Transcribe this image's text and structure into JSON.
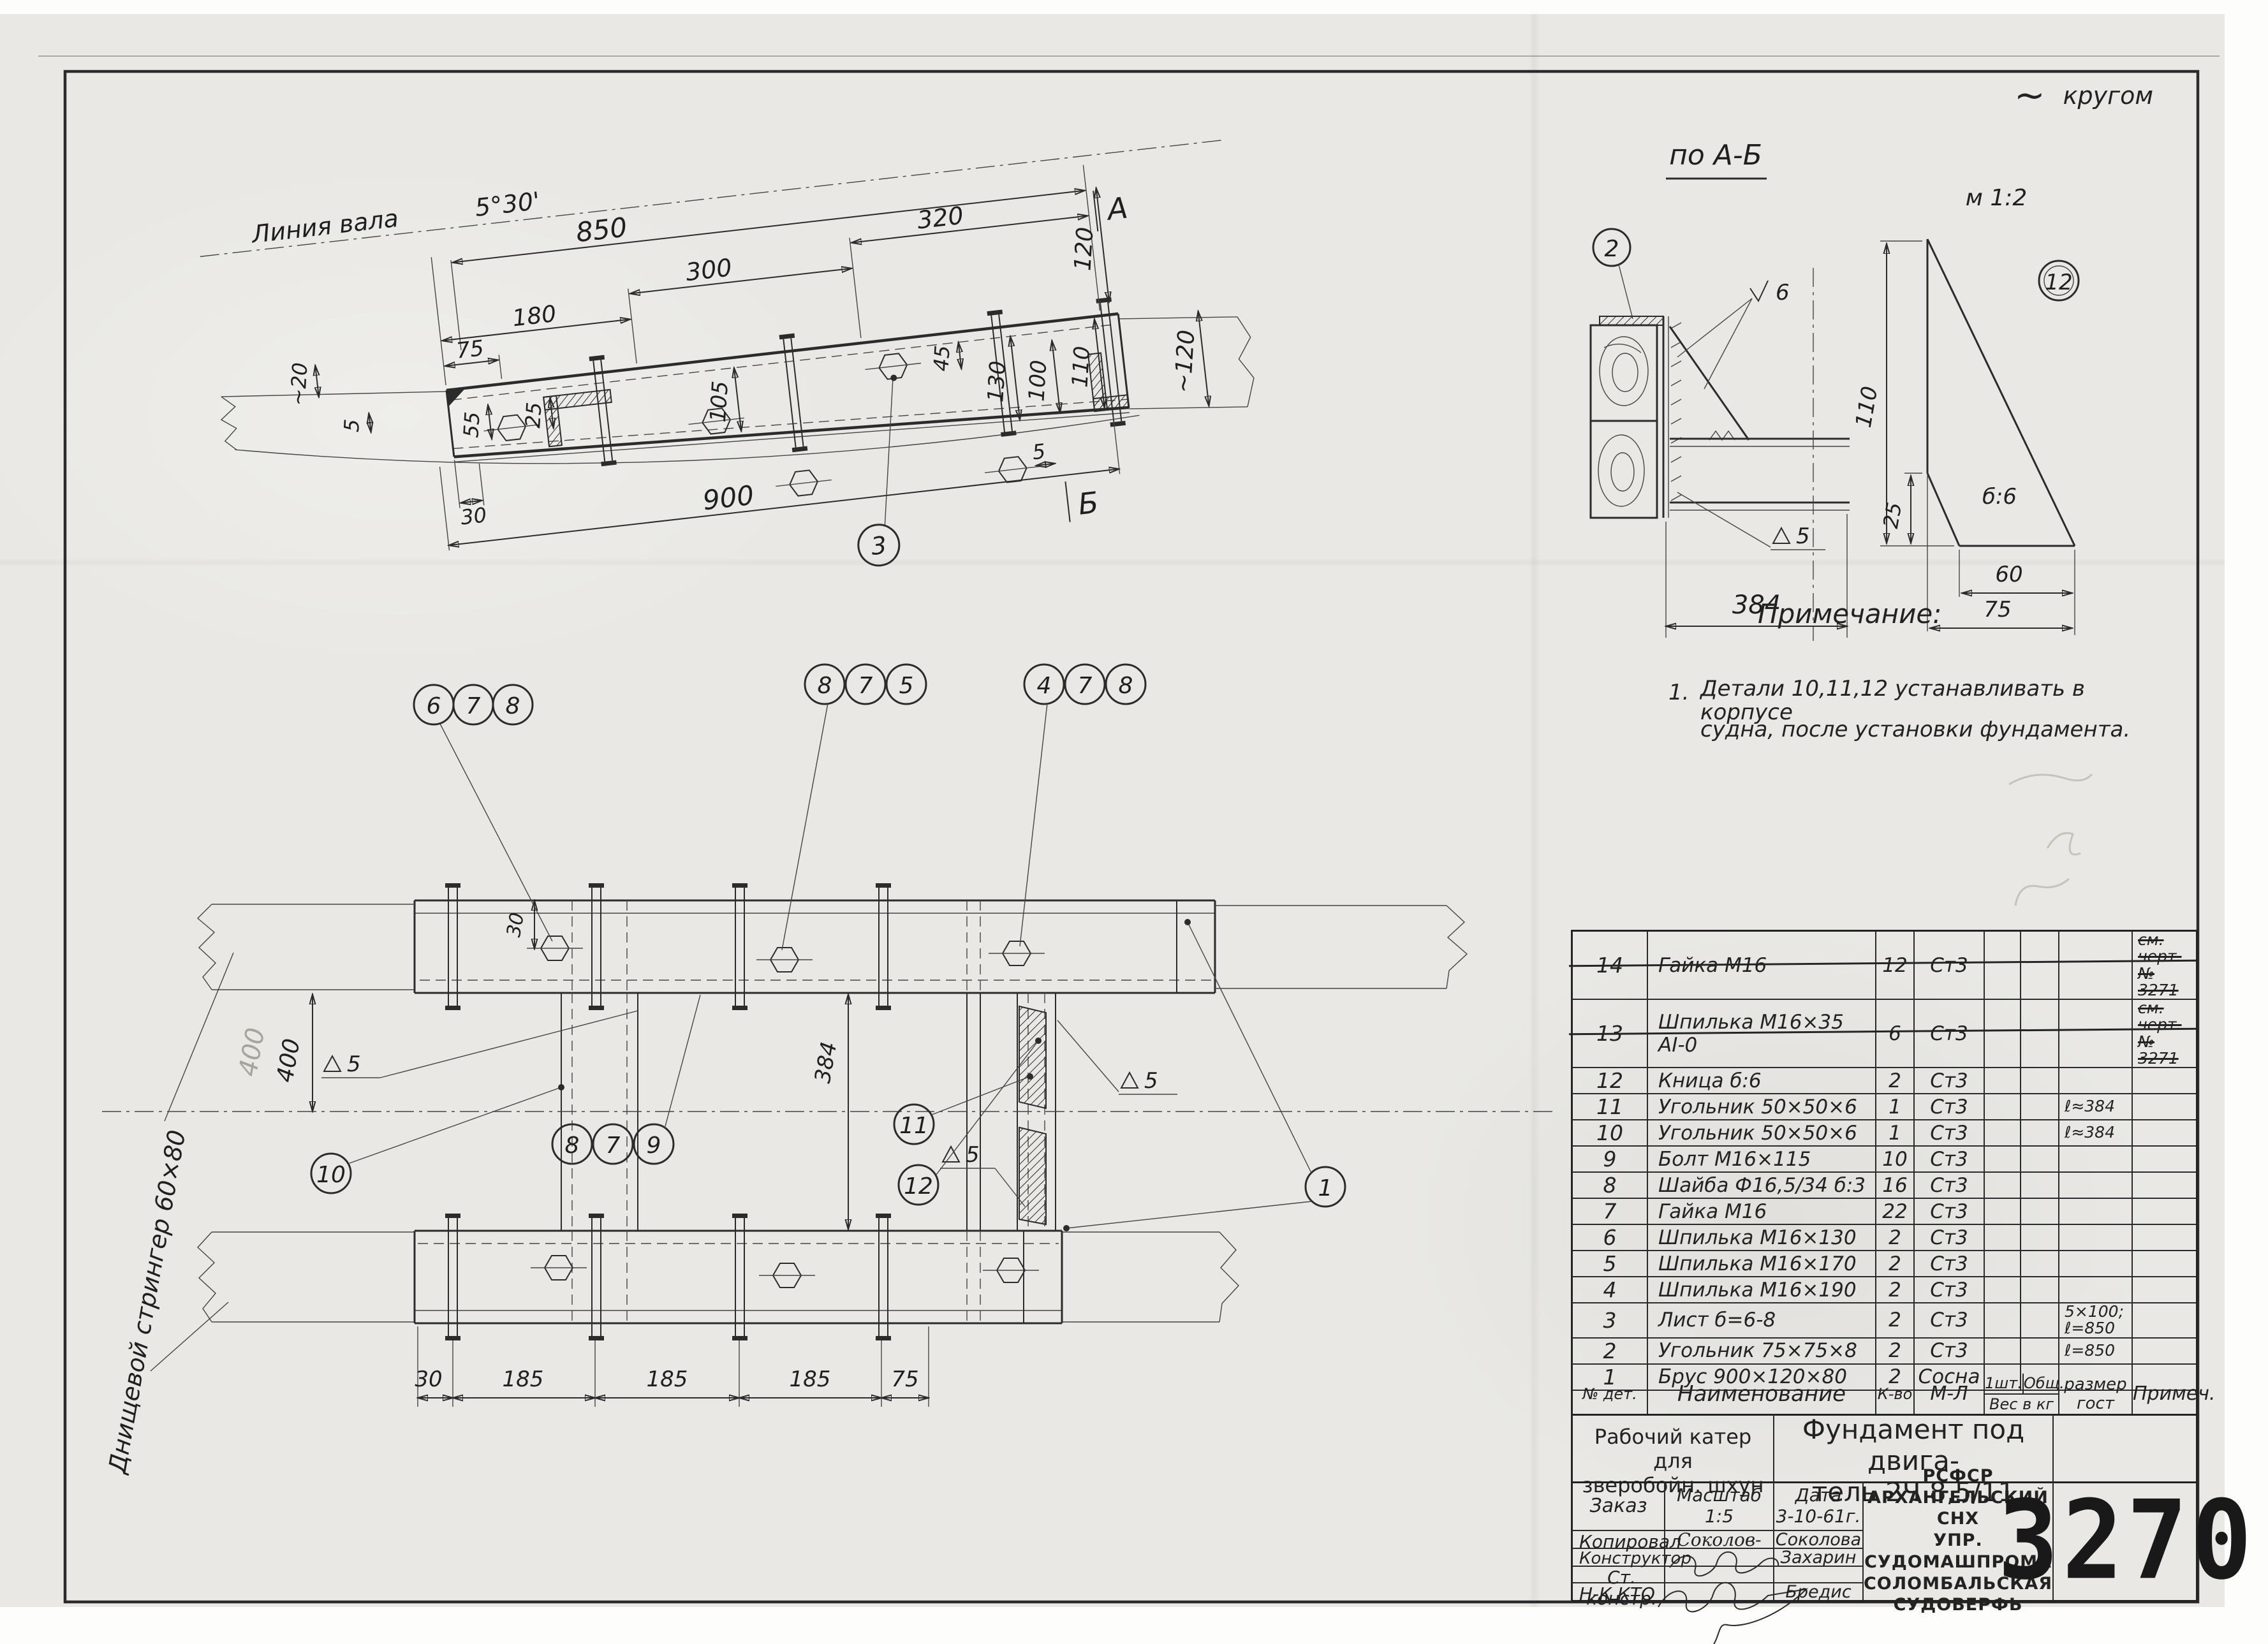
{
  "doc_number": "3270",
  "annotations": {
    "all_around_tilde": "~",
    "all_around": "кругом"
  },
  "side_view": {
    "shaft_line_label": "Линия вала",
    "shaft_angle": "5°30'",
    "marker_a": "A",
    "marker_b": "Б",
    "balloon_3": "3",
    "dims": {
      "top_850": "850",
      "top_320": "320",
      "top_300": "300",
      "top_180": "180",
      "top_75": "75",
      "bottom_900": "900",
      "bottom_30": "30",
      "bottom_5": "5",
      "left_20": "~20",
      "left_5": "5",
      "h_55": "55",
      "h_25": "25",
      "h_105": "105",
      "h_45": "45",
      "h_130": "130",
      "h_100": "100",
      "h_110": "110",
      "v_120": "120",
      "v_120_approx": "~120"
    }
  },
  "section_ab": {
    "label": "по А-Б",
    "balloon_2": "2",
    "weld_v6": "6",
    "weld_d5": "5",
    "dim_384": "384"
  },
  "detail_12": {
    "scale": "м 1:2",
    "balloon_12": "12",
    "thickness": "б:6",
    "dims": {
      "h_110": "110",
      "h_25": "25",
      "w_60": "60",
      "w_75": "75"
    }
  },
  "notes": {
    "heading": "Примечание:",
    "item_no": "1.",
    "line1": "Детали 10,11,12 устанавливать в корпусе",
    "line2": "судна, после установки фундамента."
  },
  "plan_view": {
    "stringer_label": "Днищевой стрингер 60×80",
    "balloons": {
      "trio_678": [
        "6",
        "7",
        "8"
      ],
      "trio_875": [
        "8",
        "7",
        "5"
      ],
      "trio_478": [
        "4",
        "7",
        "8"
      ],
      "trio_879": [
        "8",
        "7",
        "9"
      ],
      "b10": "10",
      "b11": "11",
      "b12": "12",
      "b1": "1"
    },
    "dims": {
      "v_400": "400",
      "v_400_pencil": "400",
      "v_384": "384",
      "v_30": "30",
      "chain": [
        "30",
        "185",
        "185",
        "185",
        "75"
      ],
      "weld_5": "5"
    }
  },
  "parts_table": {
    "columns": {
      "num": "№ дет.",
      "name": "Наименование",
      "qty": "К-во",
      "mat": "М-Л",
      "w1": "1шт.",
      "wtot": "Общ.",
      "wlabel": "Вес в кг",
      "size": [
        "размер",
        "гост"
      ],
      "note": "Примеч."
    },
    "rows": [
      {
        "num": "14",
        "name": "Гайка М16",
        "qty": "12",
        "mat": "Ст3",
        "size": "",
        "note": [
          "см. черт.",
          "№ 3271"
        ],
        "struck": true
      },
      {
        "num": "13",
        "name": "Шпилька М16×35 АI-0",
        "qty": "6",
        "mat": "Ст3",
        "size": "",
        "note": [
          "см. черт.",
          "№ 3271"
        ],
        "struck": true
      },
      {
        "num": "12",
        "name": "Кница б:6",
        "qty": "2",
        "mat": "Ст3",
        "size": "",
        "note": ""
      },
      {
        "num": "11",
        "name": "Угольник 50×50×6",
        "qty": "1",
        "mat": "Ст3",
        "size": "ℓ≈384",
        "note": ""
      },
      {
        "num": "10",
        "name": "Угольник 50×50×6",
        "qty": "1",
        "mat": "Ст3",
        "size": "ℓ≈384",
        "note": ""
      },
      {
        "num": "9",
        "name": "Болт М16×115",
        "qty": "10",
        "mat": "Ст3",
        "size": "",
        "note": ""
      },
      {
        "num": "8",
        "name": "Шайба Ф16,5/34 б:3",
        "qty": "16",
        "mat": "Ст3",
        "size": "",
        "note": ""
      },
      {
        "num": "7",
        "name": "Гайка М16",
        "qty": "22",
        "mat": "Ст3",
        "size": "",
        "note": ""
      },
      {
        "num": "6",
        "name": "Шпилька М16×130",
        "qty": "2",
        "mat": "Ст3",
        "size": "",
        "note": ""
      },
      {
        "num": "5",
        "name": "Шпилька М16×170",
        "qty": "2",
        "mat": "Ст3",
        "size": "",
        "note": ""
      },
      {
        "num": "4",
        "name": "Шпилька М16×190",
        "qty": "2",
        "mat": "Ст3",
        "size": "",
        "note": ""
      },
      {
        "num": "3",
        "name": "Лист б=6-8",
        "qty": "2",
        "mat": "Ст3",
        "size": [
          "5×100;",
          "ℓ=850"
        ],
        "note": ""
      },
      {
        "num": "2",
        "name": "Угольник 75×75×8",
        "qty": "2",
        "mat": "Ст3",
        "size": "ℓ=850",
        "note": ""
      },
      {
        "num": "1",
        "name": "Брус 900×120×80",
        "qty": "2",
        "mat": "Сосна",
        "size": "",
        "note": ""
      }
    ]
  },
  "title_block": {
    "project_lines": [
      "Рабочий катер",
      "для",
      "зверобойн. шхун"
    ],
    "title_lines": [
      "Фундамент под двига-",
      "тель 2Ч 8,5/11"
    ],
    "order_label": "Заказ",
    "scale_label": "Масштаб",
    "scale_value": "1:5",
    "date_label": "Дата",
    "date_value": "3-10-61г.",
    "sig_rows": [
      {
        "label": "Копировал",
        "signature": "Соколов-",
        "name": "Соколова"
      },
      {
        "label": "Конструктор",
        "signature": "",
        "name": "Захарин"
      },
      {
        "label": "Ст. констр.",
        "signature": "",
        "name": ""
      },
      {
        "label": "Н-К КТО",
        "signature": "",
        "name": "Бредис"
      }
    ],
    "organization_lines": [
      "РСФСР",
      "Архангельский СНХ",
      "Упр. Судомашпрома",
      "Соломбальская",
      "судоверфь"
    ],
    "number": "3270"
  }
}
